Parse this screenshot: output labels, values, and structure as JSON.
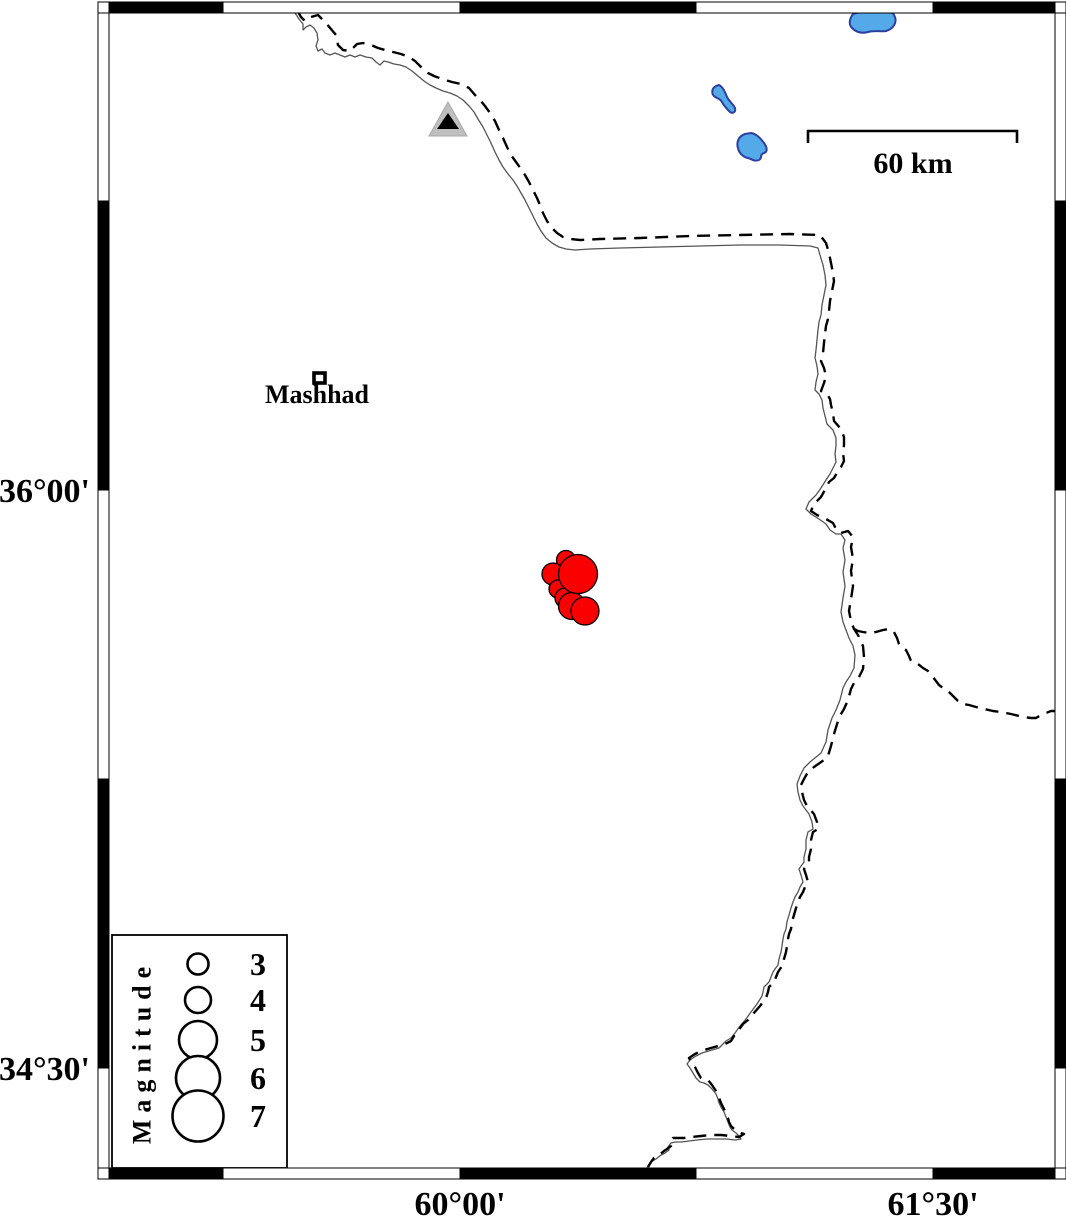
{
  "map": {
    "description": "Seismicity map around Mashhad with earthquake epicenters, international border (dashed), river (thin line), lakes, and magnitude legend",
    "graticule": {
      "lat_ticks": [
        {
          "label": "36°00'",
          "y_px": 490
        },
        {
          "label": "34°30'",
          "y_px": 1068
        }
      ],
      "lon_ticks": [
        {
          "label": "60°00'",
          "x_px": 460
        },
        {
          "label": "61°30'",
          "x_px": 933
        }
      ]
    },
    "scale_bar": {
      "label": "60 km"
    },
    "city": {
      "label": "Mashhad"
    },
    "legend": {
      "title": "Magnitude",
      "entries": [
        {
          "label": "3",
          "cy": 964,
          "r": 10.5
        },
        {
          "label": "4",
          "cy": 1000,
          "r": 13
        },
        {
          "label": "5",
          "cy": 1040,
          "r": 19
        },
        {
          "label": "6",
          "cy": 1078,
          "r": 22
        },
        {
          "label": "7",
          "cy": 1116,
          "r": 25.5
        }
      ]
    },
    "earthquakes": [
      {
        "cx": 566,
        "cy": 560,
        "r": 9.5
      },
      {
        "cx": 553,
        "cy": 574,
        "r": 11
      },
      {
        "cx": 558,
        "cy": 589,
        "r": 9
      },
      {
        "cx": 565,
        "cy": 598,
        "r": 10
      },
      {
        "cx": 572,
        "cy": 606,
        "r": 13.5
      },
      {
        "cx": 585,
        "cy": 611,
        "r": 14
      },
      {
        "cx": 578,
        "cy": 574,
        "r": 19.5
      }
    ],
    "markers": {
      "triangle": "station-triangle",
      "lakes_count": 3
    },
    "colors": {
      "earthquake_fill": "#fa0000",
      "lake_fill": "#54a9e8",
      "lake_stroke": "#2d3fa0",
      "triangle_outer": "#bfbfbf",
      "triangle_inner": "#000000",
      "frame": "#000000",
      "river": "#555555"
    }
  }
}
